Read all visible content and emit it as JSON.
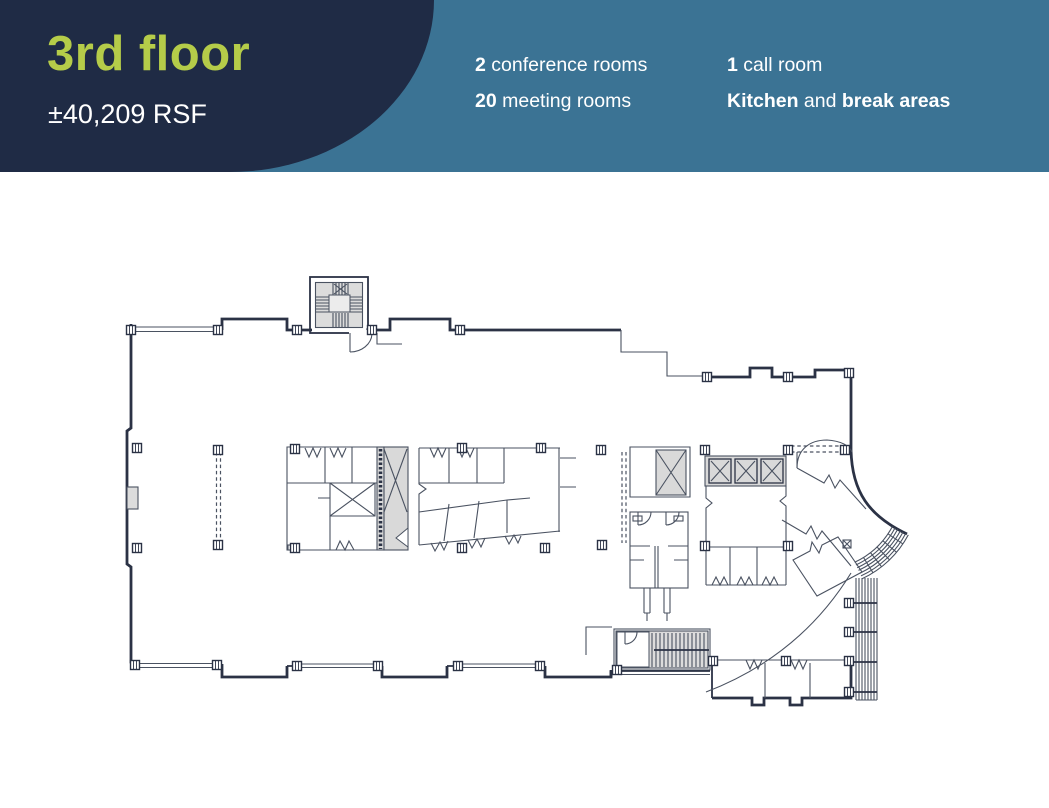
{
  "colors": {
    "navy": "#1f2b45",
    "teal": "#3b7394",
    "lime": "#b5cc49",
    "text_light": "#ffffff",
    "wall": "#2b3245",
    "thin": "#4a5261",
    "fillgray": "#d9d9d9"
  },
  "header": {
    "floor_title": "3rd floor",
    "area": "±40,209 RSF",
    "stats": [
      {
        "bold": "2",
        "rest": " conference rooms"
      },
      {
        "bold": "20",
        "rest": " meeting rooms"
      },
      {
        "bold": "1",
        "rest": " call room"
      }
    ],
    "amenities": {
      "bold_a": "Kitchen",
      "mid": " and ",
      "bold_b": "break areas"
    }
  }
}
